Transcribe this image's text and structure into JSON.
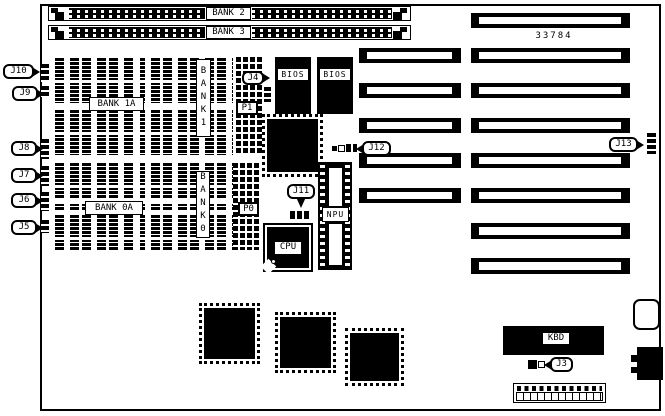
{
  "board": {
    "part_number": "33784",
    "simm_slots": {
      "bank2": "BANK 2",
      "bank3": "BANK 3"
    },
    "memory_banks": {
      "bank1a": "BANK 1A",
      "bank0a": "BANK 0A",
      "bank1_column": "BANK1",
      "bank0_column": "BANK0"
    },
    "chips": {
      "bios1": "BIOS",
      "bios2": "BIOS",
      "cpu": "CPU",
      "npu": "NPU",
      "kbd": "KBD"
    },
    "headers": {
      "j3": "J3",
      "j4": "J4",
      "j5": "J5",
      "j6": "J6",
      "j7": "J7",
      "j8": "J8",
      "j9": "J9",
      "j10": "J10",
      "j11": "J11",
      "j12": "J12",
      "j13": "J13",
      "p0": "P0",
      "p1": "P1"
    }
  }
}
